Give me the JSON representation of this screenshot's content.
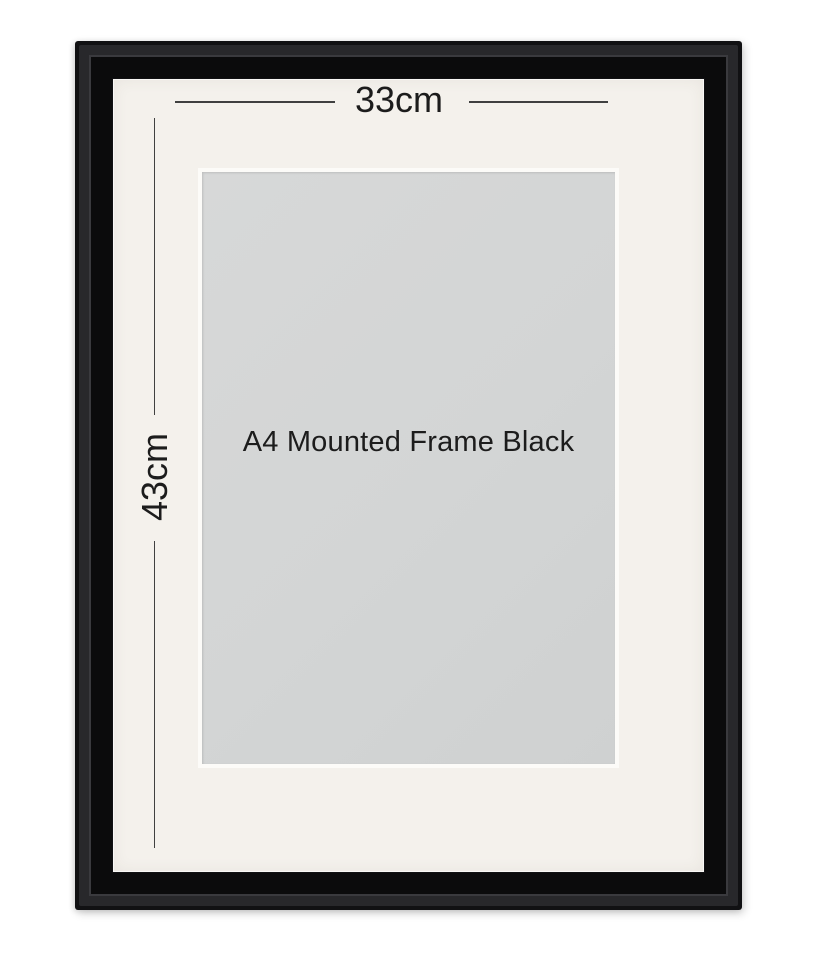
{
  "product_image": {
    "name_label": "A4 Mounted Frame Black",
    "width_dimension": "33cm",
    "height_dimension": "43cm"
  },
  "colors": {
    "background": "#ffffff",
    "frame": "#111113",
    "frame_ridge": "#28282b",
    "frame_lip": "#0b0b0c",
    "mat": "#f4f1ec",
    "opening": "#d3d5d5",
    "bevel": "#fcfbf8",
    "dimension_line": "#404040",
    "text": "#1c1c1c"
  }
}
